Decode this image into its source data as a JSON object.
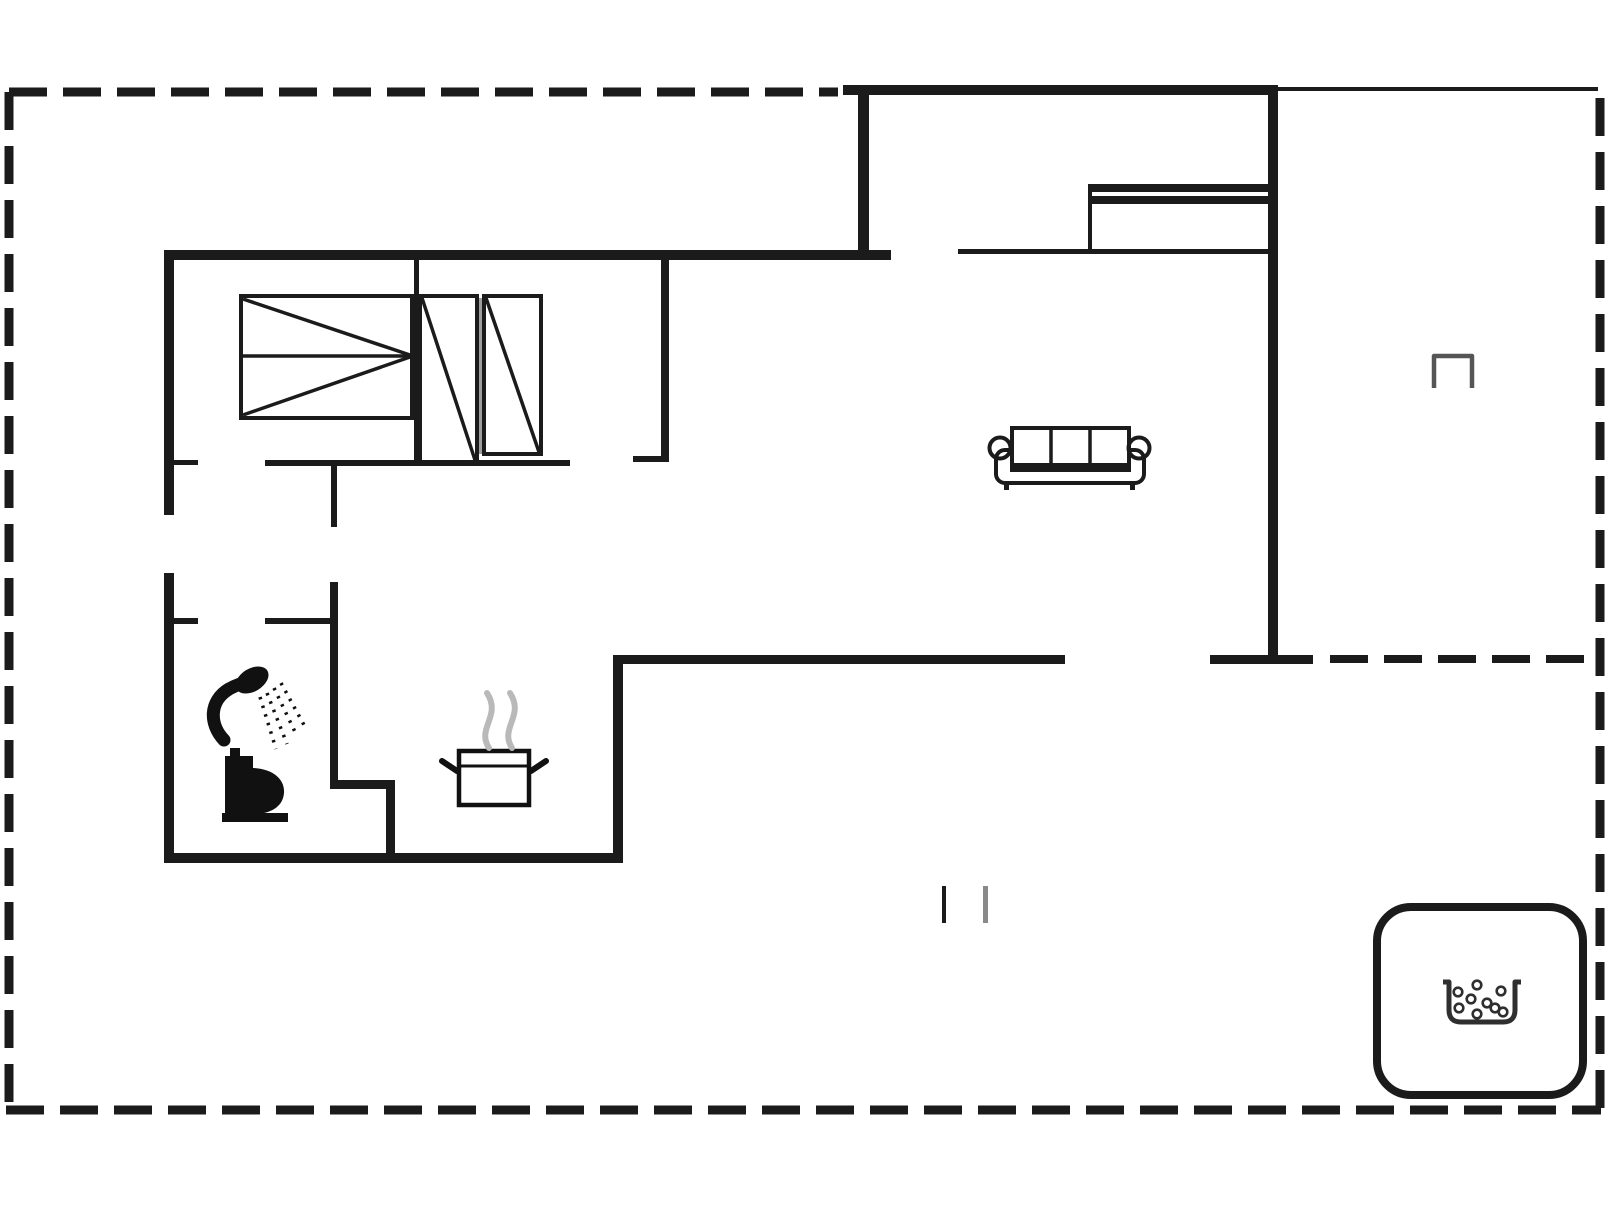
{
  "canvas": {
    "width": 1606,
    "height": 1205,
    "background": "#ffffff"
  },
  "palette": {
    "ink": "#1b1b1b",
    "icon_black": "#111111",
    "soft_gray": "#555555",
    "mid_gray": "#8a8a8a",
    "light_gray": "#b9b9b9",
    "gap_gray": "#9e9e9e",
    "white": "#ffffff"
  },
  "primitives": {
    "rects": [
      {
        "name": "wall-top-upper-section",
        "x": 843,
        "y": 85,
        "w": 435,
        "h": 10
      },
      {
        "name": "wall-upper-section-left",
        "x": 858,
        "y": 85,
        "w": 11,
        "h": 175
      },
      {
        "name": "wall-house-right",
        "x": 1268,
        "y": 85,
        "w": 10,
        "h": 578
      },
      {
        "name": "wall-main-top",
        "x": 164,
        "y": 250,
        "w": 727,
        "h": 10
      },
      {
        "name": "wall-left-upper",
        "x": 164,
        "y": 250,
        "w": 10,
        "h": 265
      },
      {
        "name": "wall-left-lower",
        "x": 164,
        "y": 573,
        "w": 10,
        "h": 290
      },
      {
        "name": "wall-bottom-left",
        "x": 164,
        "y": 853,
        "w": 458,
        "h": 10
      },
      {
        "name": "wall-kitchen-step",
        "x": 613,
        "y": 655,
        "w": 10,
        "h": 208
      },
      {
        "name": "wall-living-bottom",
        "x": 613,
        "y": 655,
        "w": 452,
        "h": 9
      },
      {
        "name": "wall-living-bottom-right",
        "x": 1210,
        "y": 655,
        "w": 103,
        "h": 9
      },
      {
        "name": "wall-bedroom-divider",
        "x": 414,
        "y": 260,
        "w": 5,
        "h": 203
      },
      {
        "name": "wall-bedroom-south",
        "x": 265,
        "y": 460,
        "w": 305,
        "h": 6
      },
      {
        "name": "door-jamb-bedroom",
        "x": 164,
        "y": 460,
        "w": 34,
        "h": 5
      },
      {
        "name": "wall-closet-east",
        "x": 661,
        "y": 260,
        "w": 8,
        "h": 198
      },
      {
        "name": "door-jamb-living",
        "x": 633,
        "y": 456,
        "w": 36,
        "h": 6
      },
      {
        "name": "wall-hall-stub",
        "x": 331,
        "y": 466,
        "w": 6,
        "h": 61
      },
      {
        "name": "wall-bath-east",
        "x": 330,
        "y": 582,
        "w": 8,
        "h": 200
      },
      {
        "name": "wall-bath-step-horizontal",
        "x": 330,
        "y": 780,
        "w": 65,
        "h": 9
      },
      {
        "name": "wall-bath-step-vertical",
        "x": 386,
        "y": 780,
        "w": 9,
        "h": 77
      },
      {
        "name": "door-jamb-bathroom",
        "x": 164,
        "y": 618,
        "w": 34,
        "h": 6
      },
      {
        "name": "wall-bath-north",
        "x": 265,
        "y": 618,
        "w": 72,
        "h": 6
      },
      {
        "name": "wall-upper-room-south-thin",
        "x": 958,
        "y": 249,
        "w": 316,
        "h": 5
      },
      {
        "name": "counter-bar-top",
        "x": 1088,
        "y": 184,
        "w": 185,
        "h": 8
      },
      {
        "name": "counter-bar-mid",
        "x": 1088,
        "y": 196,
        "w": 185,
        "h": 8
      },
      {
        "name": "counter-left-edge",
        "x": 1088,
        "y": 184,
        "w": 4,
        "h": 68
      },
      {
        "name": "roofline-top-right-thin",
        "x": 1278,
        "y": 87,
        "w": 320,
        "h": 4
      },
      {
        "name": "terrace-tick-black",
        "x": 942,
        "y": 886,
        "w": 4,
        "h": 37
      },
      {
        "name": "terrace-tick-gray",
        "x": 983,
        "y": 886,
        "w": 5,
        "h": 37,
        "fill": "#8a8a8a"
      },
      {
        "name": "wardrobe-gap-line",
        "x": 479,
        "y": 298,
        "w": 3,
        "h": 156,
        "fill": "#9e9e9e"
      },
      {
        "name": "toilet-tank",
        "x": 225,
        "y": 756,
        "w": 28,
        "h": 57,
        "fill": "#111111"
      },
      {
        "name": "toilet-flush-button",
        "x": 230,
        "y": 748,
        "w": 10,
        "h": 8,
        "fill": "#111111"
      },
      {
        "name": "toilet-base",
        "x": 222,
        "y": 813,
        "w": 66,
        "h": 9,
        "fill": "#111111"
      },
      {
        "name": "bed-frame",
        "x": 241,
        "y": 296,
        "w": 171,
        "h": 122,
        "fill": "#ffffff",
        "stroke": "#1b1b1b",
        "sw": 4
      },
      {
        "name": "wardrobe-left",
        "x": 420,
        "y": 296,
        "w": 57,
        "h": 166,
        "fill": "#ffffff",
        "stroke": "#1b1b1b",
        "sw": 4
      },
      {
        "name": "wardrobe-right",
        "x": 484,
        "y": 296,
        "w": 57,
        "h": 158,
        "fill": "#ffffff",
        "stroke": "#1b1b1b",
        "sw": 4
      },
      {
        "name": "pot-body",
        "x": 459,
        "y": 751,
        "w": 70,
        "h": 54,
        "fill": "#ffffff",
        "stroke": "#111111",
        "sw": 4.5
      },
      {
        "name": "sofa-seat",
        "x": 996,
        "y": 450,
        "w": 148,
        "h": 33,
        "rx": 9,
        "fill": "#ffffff",
        "stroke": "#1b1b1b",
        "sw": 4
      },
      {
        "name": "sofa-back-cushions",
        "x": 1012,
        "y": 428,
        "w": 117,
        "h": 42,
        "fill": "#ffffff",
        "stroke": "#1b1b1b",
        "sw": 4
      },
      {
        "name": "sofa-foot-left",
        "x": 1004,
        "y": 482,
        "w": 5,
        "h": 8
      },
      {
        "name": "sofa-foot-right",
        "x": 1130,
        "y": 482,
        "w": 5,
        "h": 8
      },
      {
        "name": "hot-tub",
        "x": 1377,
        "y": 907,
        "w": 206,
        "h": 188,
        "rx": 34,
        "fill": "#ffffff",
        "stroke": "#1b1b1b",
        "sw": 8
      }
    ],
    "circles": [
      {
        "name": "sofa-armrest-left",
        "cx": 1000,
        "cy": 448,
        "r": 10.5,
        "stroke": "#1b1b1b",
        "sw": 4
      },
      {
        "name": "sofa-armrest-right",
        "cx": 1139,
        "cy": 448,
        "r": 10.5,
        "stroke": "#1b1b1b",
        "sw": 4
      },
      {
        "name": "hot-tub-bubble-1",
        "cx": 1458,
        "cy": 992,
        "r": 4.3,
        "stroke": "#2f2f2f",
        "sw": 2.6
      },
      {
        "name": "hot-tub-bubble-2",
        "cx": 1477,
        "cy": 985,
        "r": 4.3,
        "stroke": "#2f2f2f",
        "sw": 2.6
      },
      {
        "name": "hot-tub-bubble-3",
        "cx": 1471,
        "cy": 999,
        "r": 4.3,
        "stroke": "#2f2f2f",
        "sw": 2.6
      },
      {
        "name": "hot-tub-bubble-4",
        "cx": 1487,
        "cy": 1003,
        "r": 4.3,
        "stroke": "#2f2f2f",
        "sw": 2.6
      },
      {
        "name": "hot-tub-bubble-5",
        "cx": 1459,
        "cy": 1008,
        "r": 4.3,
        "stroke": "#2f2f2f",
        "sw": 2.6
      },
      {
        "name": "hot-tub-bubble-6",
        "cx": 1477,
        "cy": 1014,
        "r": 4.3,
        "stroke": "#2f2f2f",
        "sw": 2.6
      },
      {
        "name": "hot-tub-bubble-7",
        "cx": 1495,
        "cy": 1008,
        "r": 4.3,
        "stroke": "#2f2f2f",
        "sw": 2.6
      },
      {
        "name": "hot-tub-bubble-8",
        "cx": 1501,
        "cy": 991,
        "r": 4.3,
        "stroke": "#2f2f2f",
        "sw": 2.6
      },
      {
        "name": "hot-tub-bubble-9",
        "cx": 1503,
        "cy": 1012,
        "r": 4.3,
        "stroke": "#2f2f2f",
        "sw": 2.6
      }
    ],
    "ellipses": [
      {
        "name": "shower-head-icon",
        "cx": 252,
        "cy": 680,
        "rx": 18,
        "ry": 11.5,
        "rotate": -31,
        "fill": "#111111"
      }
    ],
    "lines": [
      {
        "name": "terrace-boundary-top",
        "x1": 9,
        "y1": 92,
        "x2": 838,
        "y2": 92,
        "sw": 9,
        "dash": "38 16"
      },
      {
        "name": "terrace-boundary-left",
        "x1": 9,
        "y1": 92,
        "x2": 9,
        "y2": 1106,
        "sw": 9,
        "dash": "38 16"
      },
      {
        "name": "terrace-boundary-bottom",
        "x1": 6,
        "y1": 1110,
        "x2": 1601,
        "y2": 1110,
        "sw": 9,
        "dash": "38 16"
      },
      {
        "name": "terrace-boundary-right",
        "x1": 1600,
        "y1": 98,
        "x2": 1600,
        "y2": 1110,
        "sw": 9,
        "dash": "38 16"
      },
      {
        "name": "terrace-divider-dashed",
        "x1": 1330,
        "y1": 659,
        "x2": 1597,
        "y2": 659,
        "sw": 8,
        "dash": "38 16"
      },
      {
        "name": "bed-midline",
        "x1": 241,
        "y1": 356,
        "x2": 412,
        "y2": 356,
        "sw": 3.5
      },
      {
        "name": "bed-diagonal-top",
        "x1": 243,
        "y1": 299,
        "x2": 410,
        "y2": 355,
        "sw": 3.5
      },
      {
        "name": "bed-diagonal-bottom",
        "x1": 243,
        "y1": 415,
        "x2": 410,
        "y2": 357,
        "sw": 3.5
      },
      {
        "name": "wardrobe-left-diagonal",
        "x1": 422,
        "y1": 298,
        "x2": 475,
        "y2": 460,
        "sw": 3.5
      },
      {
        "name": "wardrobe-right-diagonal",
        "x1": 486,
        "y1": 298,
        "x2": 539,
        "y2": 452,
        "sw": 3.5
      },
      {
        "name": "sofa-cushion-divider-1",
        "x1": 1051,
        "y1": 428,
        "x2": 1051,
        "y2": 470,
        "sw": 3.5
      },
      {
        "name": "sofa-cushion-divider-2",
        "x1": 1090,
        "y1": 428,
        "x2": 1090,
        "y2": 470,
        "sw": 3.5
      },
      {
        "name": "sofa-cushion-front-edge",
        "x1": 1012,
        "y1": 466,
        "x2": 1129,
        "y2": 466,
        "sw": 6
      },
      {
        "name": "pot-rim",
        "x1": 459,
        "y1": 766,
        "x2": 529,
        "y2": 766,
        "sw": 3,
        "stroke": "#111111"
      },
      {
        "name": "pot-handle-left",
        "x1": 457,
        "y1": 771,
        "x2": 442,
        "y2": 761,
        "sw": 6,
        "cap": "round",
        "stroke": "#111111"
      },
      {
        "name": "pot-handle-right",
        "x1": 531,
        "y1": 771,
        "x2": 546,
        "y2": 761,
        "sw": 6,
        "cap": "round",
        "stroke": "#111111"
      },
      {
        "name": "shower-spray-1",
        "x1": 260,
        "y1": 697,
        "x2": 276,
        "y2": 749,
        "sw": 3.5,
        "dash": "2.5 6.5",
        "stroke": "#111111"
      },
      {
        "name": "shower-spray-2",
        "x1": 267,
        "y1": 693,
        "x2": 287,
        "y2": 744,
        "sw": 3.5,
        "dash": "2.5 6.5",
        "stroke": "#111111"
      },
      {
        "name": "shower-spray-3",
        "x1": 274,
        "y1": 688,
        "x2": 297,
        "y2": 736,
        "sw": 3.5,
        "dash": "2.5 6.5",
        "stroke": "#111111"
      },
      {
        "name": "shower-spray-4",
        "x1": 281,
        "y1": 683,
        "x2": 304,
        "y2": 725,
        "sw": 3.5,
        "dash": "2.5 6.5",
        "stroke": "#111111"
      }
    ],
    "paths": [
      {
        "name": "steam-wisp-left",
        "d": "M 489 748 C 476 728 502 716 487 693",
        "stroke": "#b9b9b9",
        "sw": 6,
        "cap": "round"
      },
      {
        "name": "steam-wisp-right",
        "d": "M 512 748 C 499 728 525 716 510 693",
        "stroke": "#b9b9b9",
        "sw": 6,
        "cap": "round"
      },
      {
        "name": "shower-hose-arm",
        "d": "M 224 740 C 209 724 209 701 229 689 C 238 684 246 682 252 681",
        "stroke": "#111111",
        "sw": 13,
        "cap": "round"
      },
      {
        "name": "toilet-bowl",
        "d": "M 253 768 C 274 769 285 780 284 793 C 283 807 270 814 254 814 L 253 814 Z",
        "fill": "#111111"
      },
      {
        "name": "grill-bracket-icon",
        "d": "M 1434 388 L 1434 356 L 1472 356 L 1472 388",
        "stroke": "#555555",
        "sw": 4.5
      },
      {
        "name": "hot-tub-basin",
        "d": "M 1443 982 L 1449 982 L 1449 1010 Q 1449 1022 1461 1022 L 1503 1022 Q 1515 1022 1515 1010 L 1515 982 L 1521 982",
        "stroke": "#2f2f2f",
        "sw": 5
      }
    ]
  }
}
